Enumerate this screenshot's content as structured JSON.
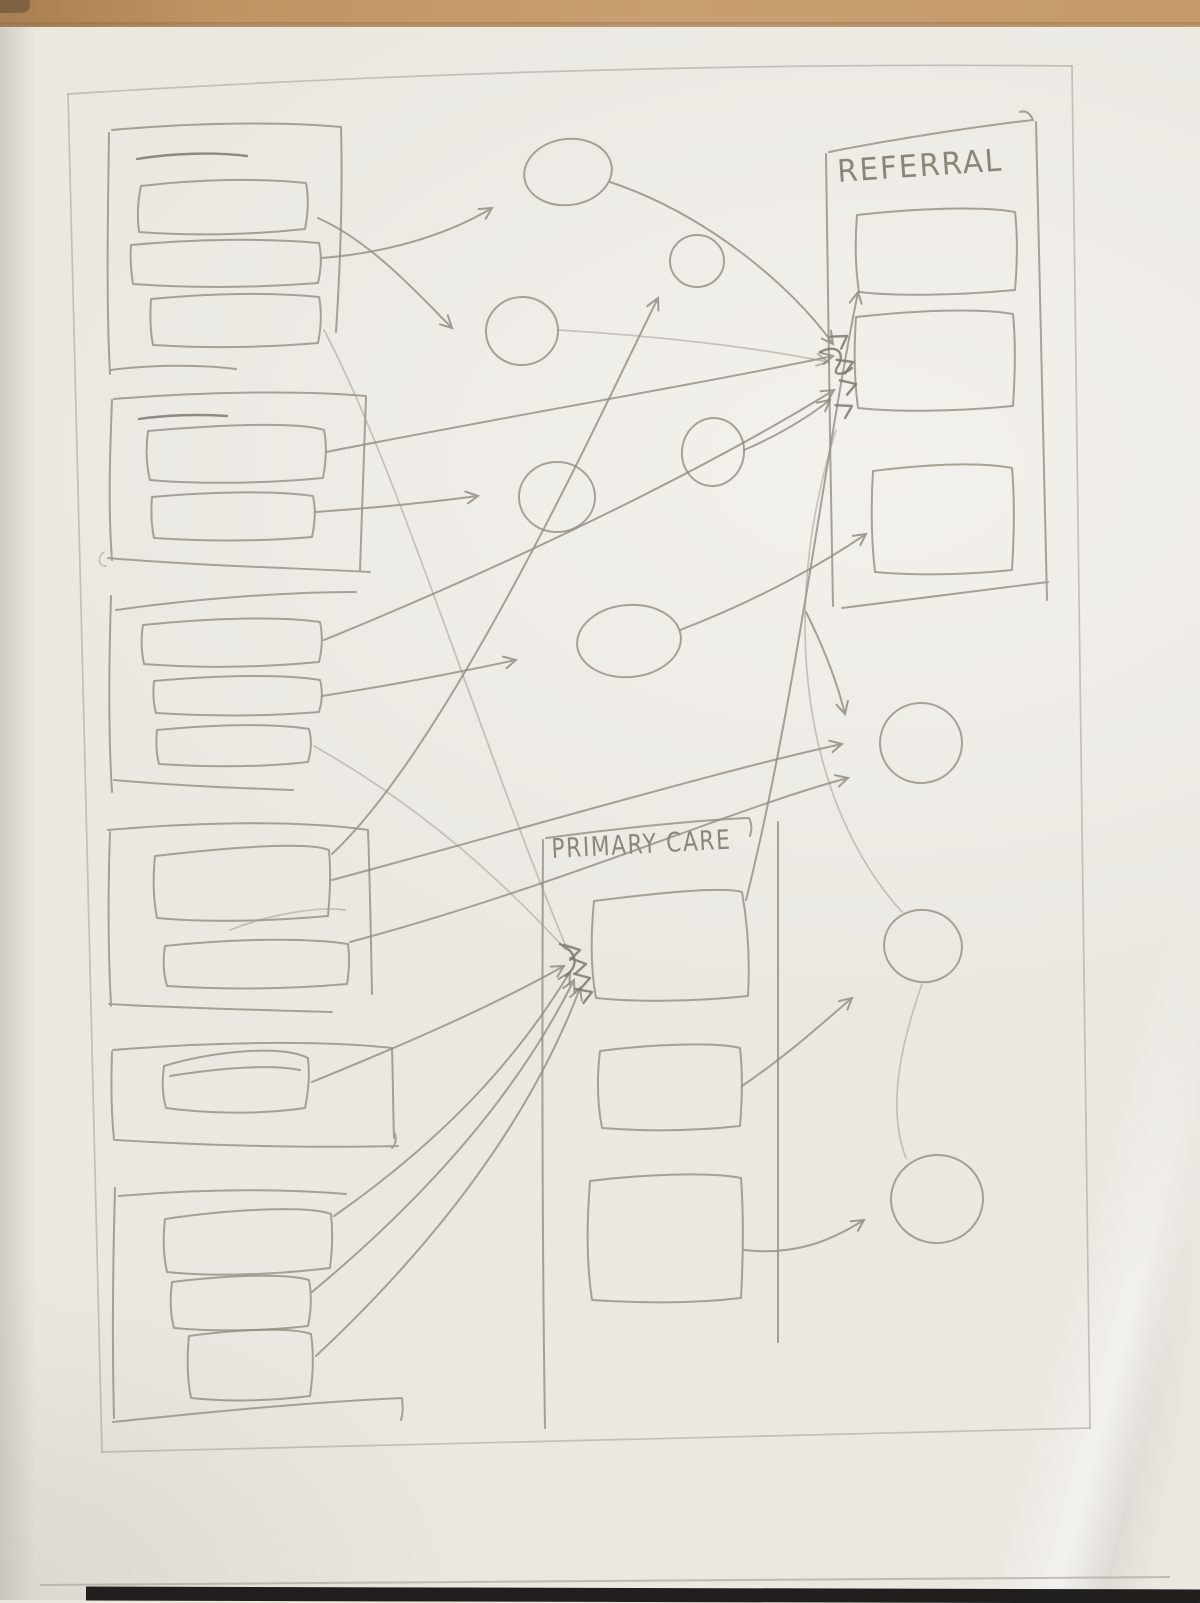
{
  "photo": {
    "desk_color": "#c49a6a",
    "paper_color": "#ebe8e2",
    "pencil_color": "#938d81",
    "bottom_shadow_color": "#201f1d"
  },
  "sketch": {
    "referral": {
      "label": "REFERRAL",
      "items": 3
    },
    "primary_care": {
      "label": "PRIMARY CARE",
      "items": 3
    },
    "left_groups": [
      {
        "name": "group-1",
        "rows": 3
      },
      {
        "name": "group-2",
        "rows": 2
      },
      {
        "name": "group-3",
        "rows": 3
      },
      {
        "name": "group-4",
        "rows": 2
      },
      {
        "name": "group-5",
        "rows": 1
      },
      {
        "name": "group-6",
        "rows": 3
      }
    ],
    "mid_circle_count": 6,
    "right_circle_count": 3,
    "connector_count": 25
  }
}
